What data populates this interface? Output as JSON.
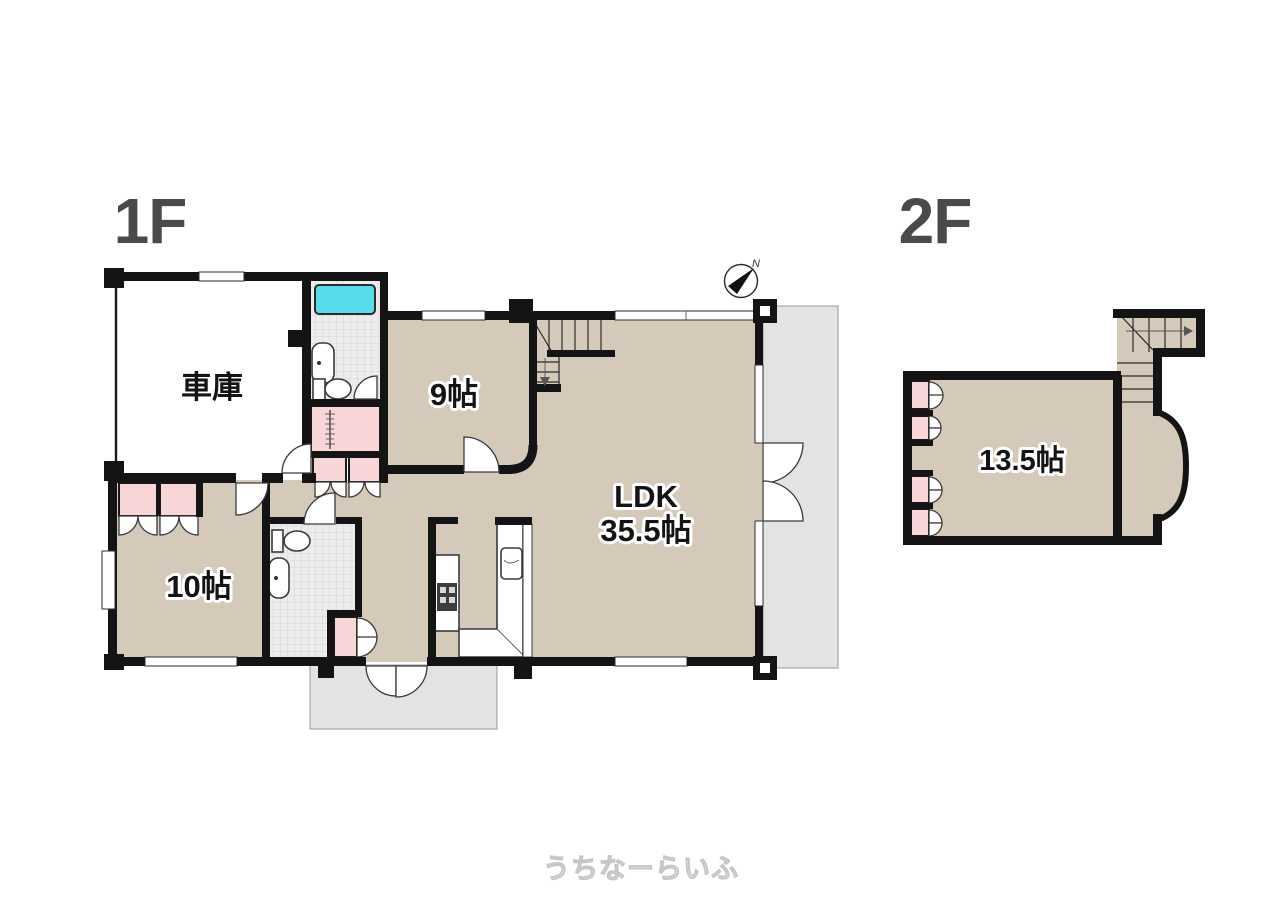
{
  "floor_1f": {
    "title": "1F",
    "garage_label": "車庫",
    "room9_label": "9帖",
    "ldk_label": "LDK",
    "ldk_size": "35.5帖",
    "room10_label": "10帖"
  },
  "floor_2f": {
    "title": "2F",
    "room_label": "13.5帖"
  },
  "compass": {
    "north": "N"
  },
  "watermark": {
    "text": "うちなーらいふ"
  },
  "colors": {
    "floor": "#d5c9b9",
    "closet_pink": "#f8d5d6",
    "bathtub_cyan": "#57dce9",
    "outdoor_gray": "#e3e3e3",
    "tile": "#ededed",
    "wall": "#141414",
    "title_gray": "#4a4a4a"
  }
}
